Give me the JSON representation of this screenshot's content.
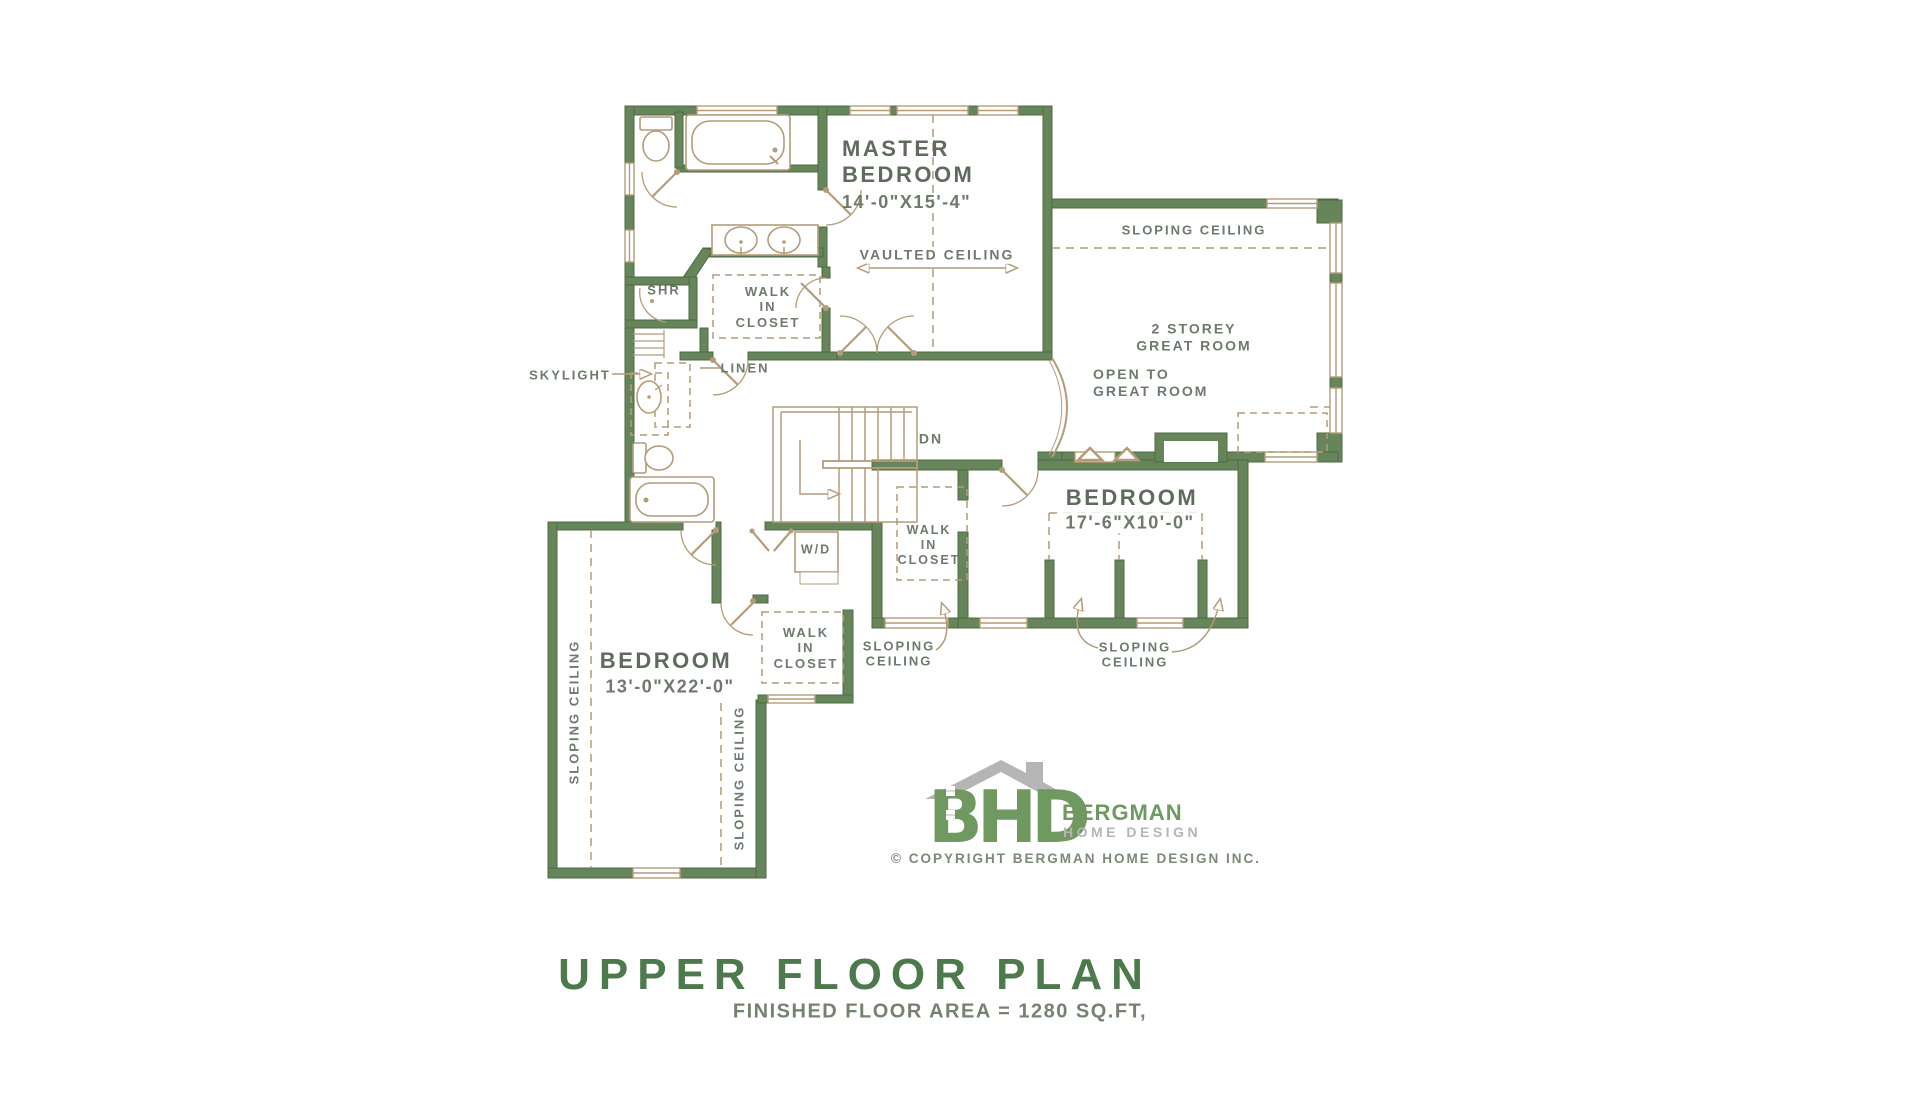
{
  "plan": {
    "rooms": {
      "master": {
        "name_1": "MASTER",
        "name_2": "BEDROOM",
        "dims": "14'-0\"X15'-4\""
      },
      "bedroom_label": "BEDROOM",
      "bedroom2_dims": "17'-6\"X10'-0\"",
      "bedroom3_dims": "13'-0\"X22'-0\"",
      "great_room_1": "2 STOREY",
      "great_room_2": "GREAT ROOM",
      "open_to_1": "OPEN TO",
      "open_to_2": "GREAT ROOM"
    },
    "labels": {
      "vaulted_ceiling": "VAULTED CEILING",
      "sloping_ceiling": "SLOPING CEILING",
      "sloping_1": "SLOPING",
      "sloping_2": "CEILING",
      "wic_1": "WALK",
      "wic_2": "IN",
      "wic_3": "CLOSET",
      "shr": "SHR",
      "skylight": "SKYLIGHT",
      "linen": "LINEN",
      "dn": "DN",
      "wd": "W/D"
    }
  },
  "branding": {
    "logo_text": "BHD",
    "brand_name": "BERGMAN",
    "brand_sub": "HOME DESIGN",
    "copyright": "© COPYRIGHT BERGMAN HOME DESIGN INC."
  },
  "footer": {
    "title": "UPPER FLOOR PLAN",
    "subtitle": "FINISHED FLOOR AREA = 1280 SQ.FT,"
  },
  "colors": {
    "wall_green": "#67855b",
    "fixture_tan": "#b49c79",
    "text_green_gray": "#6d7a6c",
    "title_green": "#4d7a4c",
    "logo_green": "#6f9960",
    "logo_gray": "#b5b5b5"
  }
}
